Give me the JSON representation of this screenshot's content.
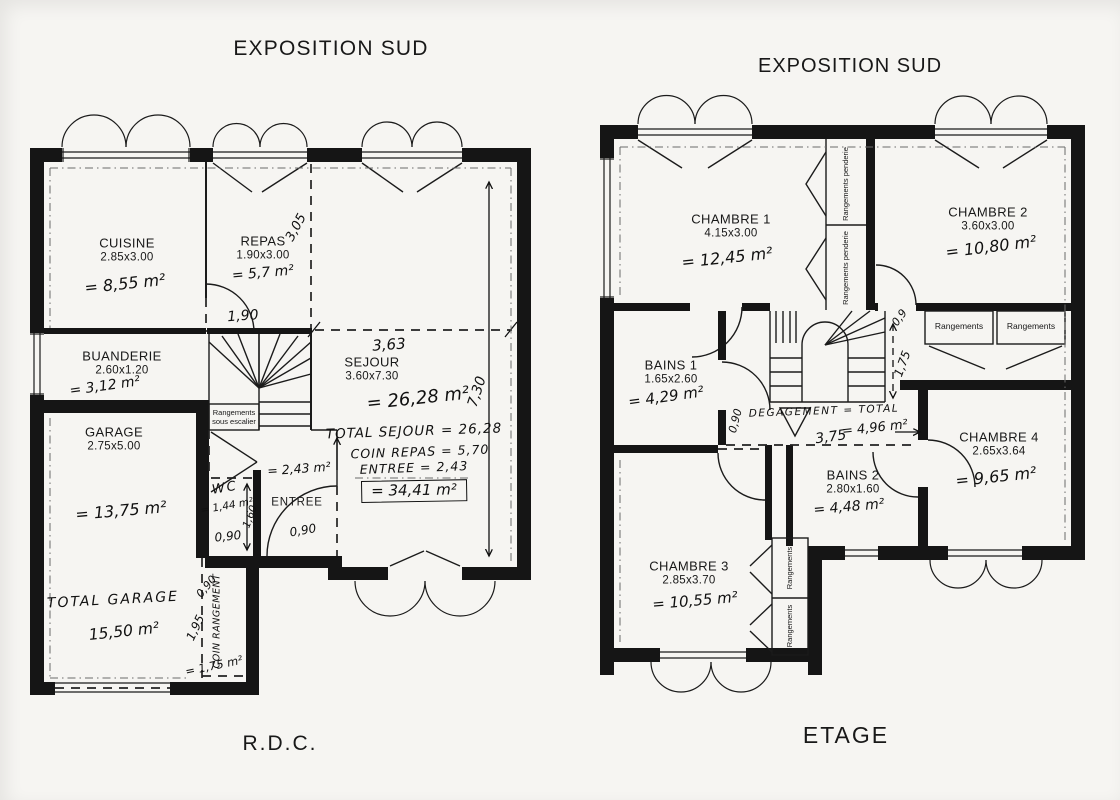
{
  "rdc": {
    "exposure": "EXPOSITION SUD",
    "floor": "R.D.C.",
    "cuisine": {
      "name": "CUISINE",
      "dims": "2.85x3.00",
      "area": "= 8,55 m²"
    },
    "repas": {
      "name": "REPAS",
      "dims": "1.90x3.00",
      "area": "= 5,7 m²",
      "depth": "3,05"
    },
    "buanderie": {
      "name": "BUANDERIE",
      "dims": "2.60x1.20",
      "area": "= 3,12 m²"
    },
    "sejour": {
      "name": "SEJOUR",
      "dims": "3.60x7.30",
      "area": "= 26,28 m²",
      "width": "3,63",
      "length": "7,30"
    },
    "escalier": {
      "label": "Rangements sous escalier",
      "width": "1,90"
    },
    "wc": {
      "name": "WC",
      "area": "= 1,44 m²",
      "width": "0,90",
      "depth": "1,60"
    },
    "entree": {
      "name": "ENTREE",
      "area": "= 2,43 m²",
      "door": "0,90"
    },
    "garage": {
      "name": "GARAGE",
      "dims": "2.75x5.00",
      "area": "= 13,75 m²",
      "total_label": "TOTAL GARAGE",
      "total_area": "15,50 m²"
    },
    "coin_rangement": {
      "label": "COIN RANGEMENT",
      "width": "0,90",
      "depth": "1,95",
      "area": "= 1,75 m²"
    },
    "totaux": {
      "sejour": "TOTAL SEJOUR = 26,28",
      "coin_repas": "COIN REPAS = 5,70",
      "entree": "ENTREE = 2,43",
      "total": "= 34,41 m²"
    }
  },
  "etage": {
    "exposure": "EXPOSITION SUD",
    "floor": "ETAGE",
    "chambre1": {
      "name": "CHAMBRE 1",
      "dims": "4.15x3.00",
      "area": "= 12,45 m²"
    },
    "chambre2": {
      "name": "CHAMBRE 2",
      "dims": "3.60x3.00",
      "area": "= 10,80 m²"
    },
    "bains1": {
      "name": "BAINS 1",
      "dims": "1.65x2.60",
      "area": "= 4,29 m²"
    },
    "bains2": {
      "name": "BAINS 2",
      "dims": "2.80x1.60",
      "area": "= 4,48 m²"
    },
    "chambre3": {
      "name": "CHAMBRE 3",
      "dims": "2.85x3.70",
      "area": "= 10,55 m²"
    },
    "chambre4": {
      "name": "CHAMBRE 4",
      "dims": "2.65x3.64",
      "area": "= 9,65 m²"
    },
    "degagement": {
      "label": "DEGAGEMENT = TOTAL",
      "area": "= 4,96 m²",
      "length": "3,75"
    },
    "penderie1": "Rangements penderie",
    "penderie2": "Rangements penderie",
    "rangement1": "Rangements",
    "rangement2": "Rangements",
    "rangement3": "Rangements",
    "rangement4": "Rangements",
    "dims": {
      "porte": "0,9",
      "palier": "1,75",
      "couloir": "0,90"
    }
  },
  "colors": {
    "ink": "#151515",
    "paper": "#f6f5f2"
  }
}
